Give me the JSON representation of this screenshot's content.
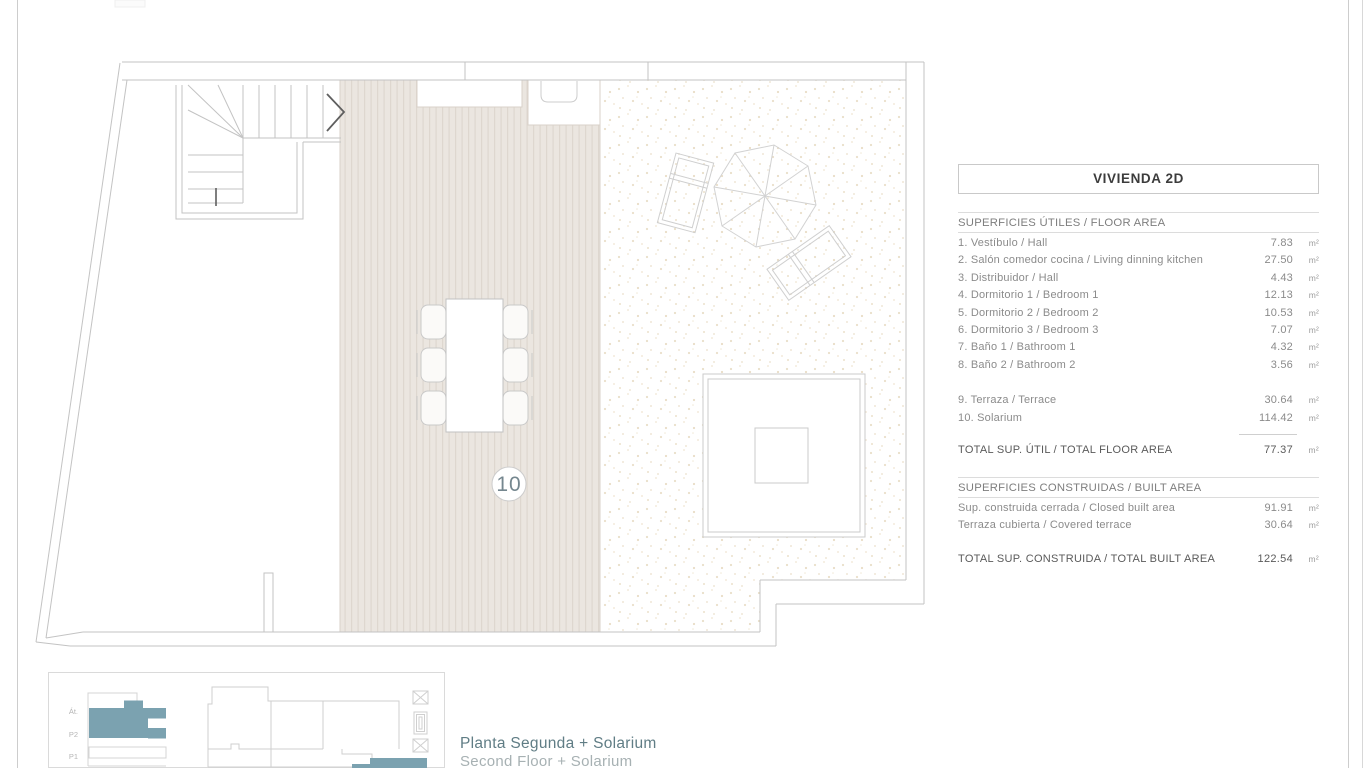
{
  "panel": {
    "title": "VIVIENDA 2D",
    "floor_area": {
      "header": "SUPERFICIES ÚTILES / FLOOR AREA",
      "rows": [
        {
          "label": "1. Vestíbulo / Hall",
          "value": "7.83",
          "unit": "m²"
        },
        {
          "label": "2. Salón comedor cocina / Living dinning kitchen",
          "value": "27.50",
          "unit": "m²"
        },
        {
          "label": "3. Distribuidor / Hall",
          "value": "4.43",
          "unit": "m²"
        },
        {
          "label": "4. Dormitorio 1 / Bedroom 1",
          "value": "12.13",
          "unit": "m²"
        },
        {
          "label": "5. Dormitorio 2 / Bedroom 2",
          "value": "10.53",
          "unit": "m²"
        },
        {
          "label": "6. Dormitorio 3 / Bedroom 3",
          "value": "7.07",
          "unit": "m²"
        },
        {
          "label": "7. Baño 1 / Bathroom 1",
          "value": "4.32",
          "unit": "m²"
        },
        {
          "label": "8. Baño 2 / Bathroom 2",
          "value": "3.56",
          "unit": "m²"
        }
      ],
      "extra_rows": [
        {
          "label": "9. Terraza / Terrace",
          "value": "30.64",
          "unit": "m²"
        },
        {
          "label": "10. Solarium",
          "value": "114.42",
          "unit": "m²"
        }
      ],
      "total": {
        "label": "TOTAL SUP. ÚTIL / TOTAL FLOOR AREA",
        "value": "77.37",
        "unit": "m²"
      }
    },
    "built_area": {
      "header": "SUPERFICIES CONSTRUIDAS / BUILT AREA",
      "rows": [
        {
          "label": "Sup. construida cerrada / Closed built area",
          "value": "91.91",
          "unit": "m²"
        },
        {
          "label": "Terraza cubierta / Covered terrace",
          "value": "30.64",
          "unit": "m²"
        }
      ],
      "total": {
        "label": "TOTAL SUP. CONSTRUIDA /  TOTAL BUILT AREA",
        "value": "122.54",
        "unit": "m²"
      }
    }
  },
  "plan": {
    "room_number": "10"
  },
  "mini_plan": {
    "floor_labels": [
      "Át.",
      "P2",
      "P1"
    ]
  },
  "caption": {
    "line1": "Planta Segunda + Solarium",
    "line2": "Second Floor + Solarium"
  },
  "colors": {
    "accent_teal": "#7ba2b0",
    "caption_primary": "#607d85",
    "caption_secondary": "#a7b1b3",
    "plan_line": "#c3c3c3",
    "deck_fill": "#ebe6e0"
  }
}
